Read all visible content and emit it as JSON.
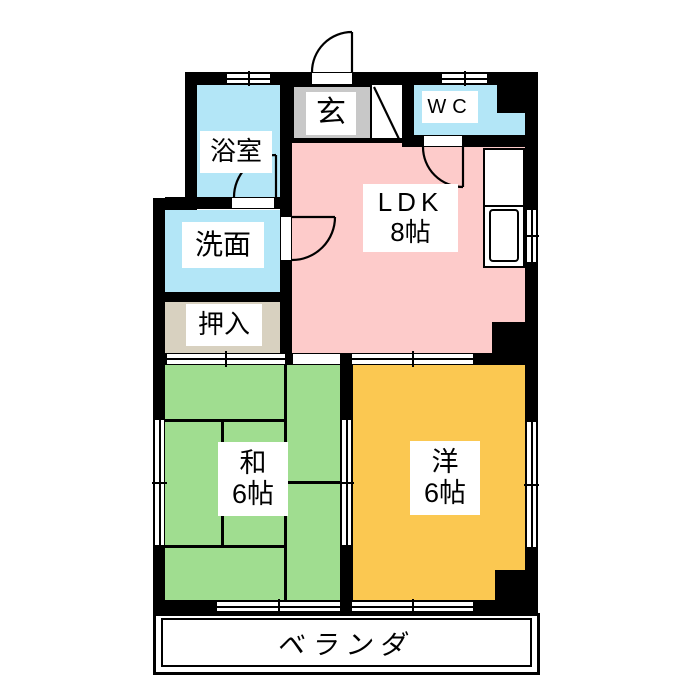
{
  "plan_title": "2DK apartment floor plan",
  "rooms": {
    "bath": {
      "label": "浴室"
    },
    "entrance": {
      "label": "玄"
    },
    "wc": {
      "label": "WC"
    },
    "washroom": {
      "label": "洗面"
    },
    "closet": {
      "label": "押入"
    },
    "ldk": {
      "label": "LDK",
      "size": "8帖"
    },
    "japanese": {
      "label": "和",
      "size": "6帖"
    },
    "western": {
      "label": "洋",
      "size": "6帖"
    },
    "veranda": {
      "label": "ベランダ"
    }
  },
  "colors": {
    "wall": "#000000",
    "room_blue": "#b3e6f7",
    "room_pink": "#fdcbca",
    "room_gray": "#c8c8c8",
    "room_beige": "#d8d1c0",
    "room_green": "#a0dd90",
    "room_orange": "#fbc851",
    "bg": "#ffffff"
  }
}
